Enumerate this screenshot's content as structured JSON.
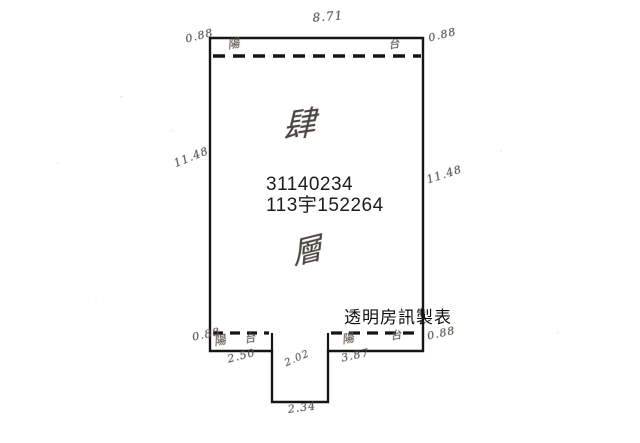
{
  "plan": {
    "parcel_number": "31140234",
    "case_number": "113宇152264",
    "credit_watermark": "透明房訊製表",
    "floor": {
      "numeral": "肆",
      "unit": "層"
    },
    "dimensions": {
      "top_width": "8.71",
      "left_height": "11.48",
      "right_height": "11.48",
      "balcony_depth_top_left": "0.88",
      "balcony_depth_top_right": "0.88",
      "balcony_depth_bottom_left": "0.88",
      "balcony_depth_bottom_right": "0.88",
      "bottom_left_width": "2.50",
      "notch_side": "2.02",
      "notch_bottom_width": "2.34",
      "bottom_right_width": "3.87"
    },
    "balcony_marks": {
      "top_left": "陽",
      "top_right": "台",
      "bottom_left_a": "陽",
      "bottom_left_b": "台",
      "bottom_right_a": "陽",
      "bottom_right_b": "台"
    },
    "colors": {
      "outline": "#151515",
      "printed_text": "#1c1c1c",
      "handwriting": "#555048",
      "background": "#ffffff"
    }
  }
}
